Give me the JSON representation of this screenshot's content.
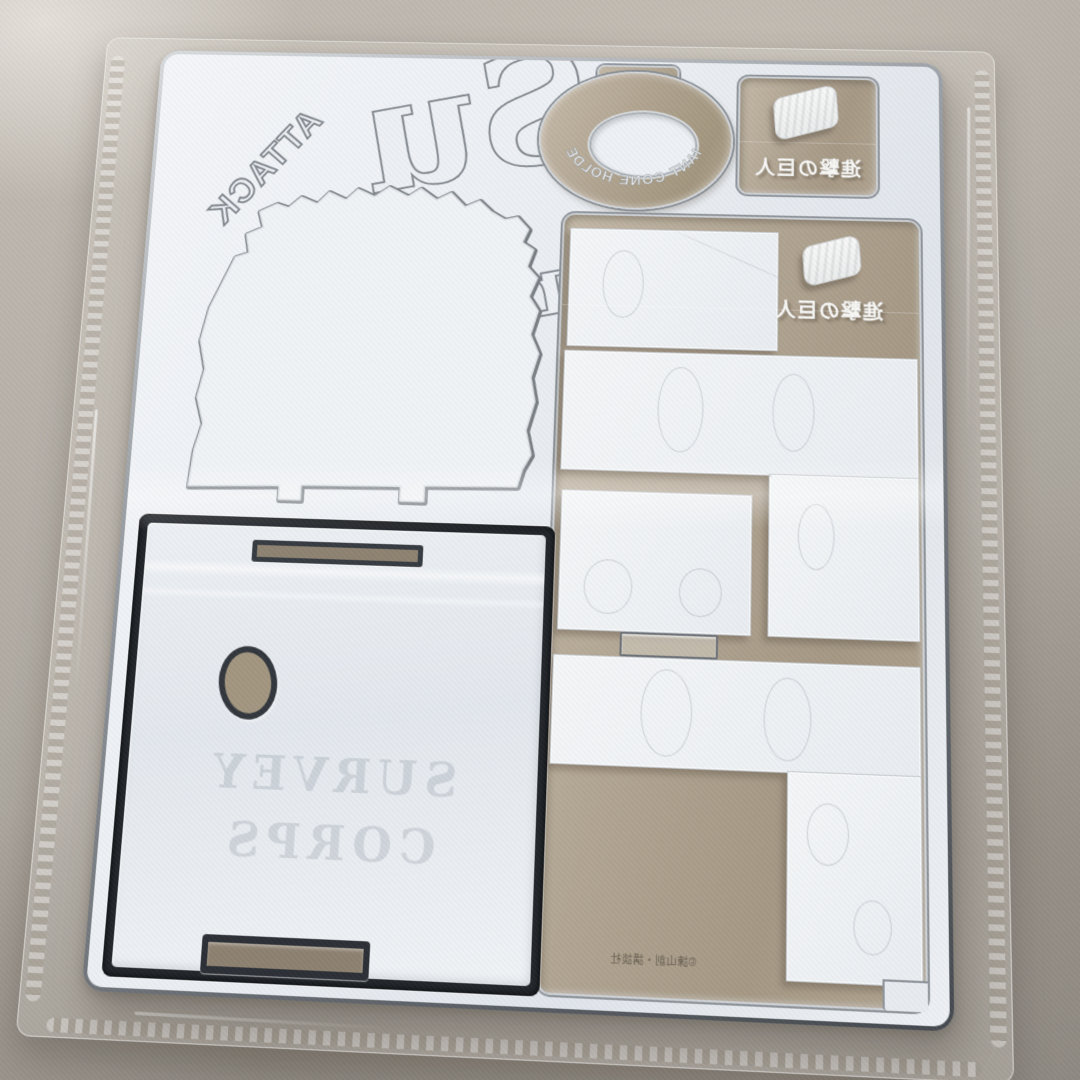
{
  "texts": {
    "attack": "ATTACK",
    "logo_fragment": "Su",
    "logo_fragment_partial": "r",
    "cone_holder": "GIANT CONE HOLDER",
    "jp_title": "進撃の巨人",
    "base_line1": "SURVEY",
    "base_line2": "CORPS",
    "copyright": "©諫山創・講談社"
  },
  "colors": {
    "table_surface": "#b2aca4",
    "sheet_white": "#eef1f5",
    "clear_backing_tan": "#b1a492",
    "bevel_silver": "#9aa0a6",
    "recess_dark": "#23262c",
    "piece_white": "#f2f4f6"
  }
}
